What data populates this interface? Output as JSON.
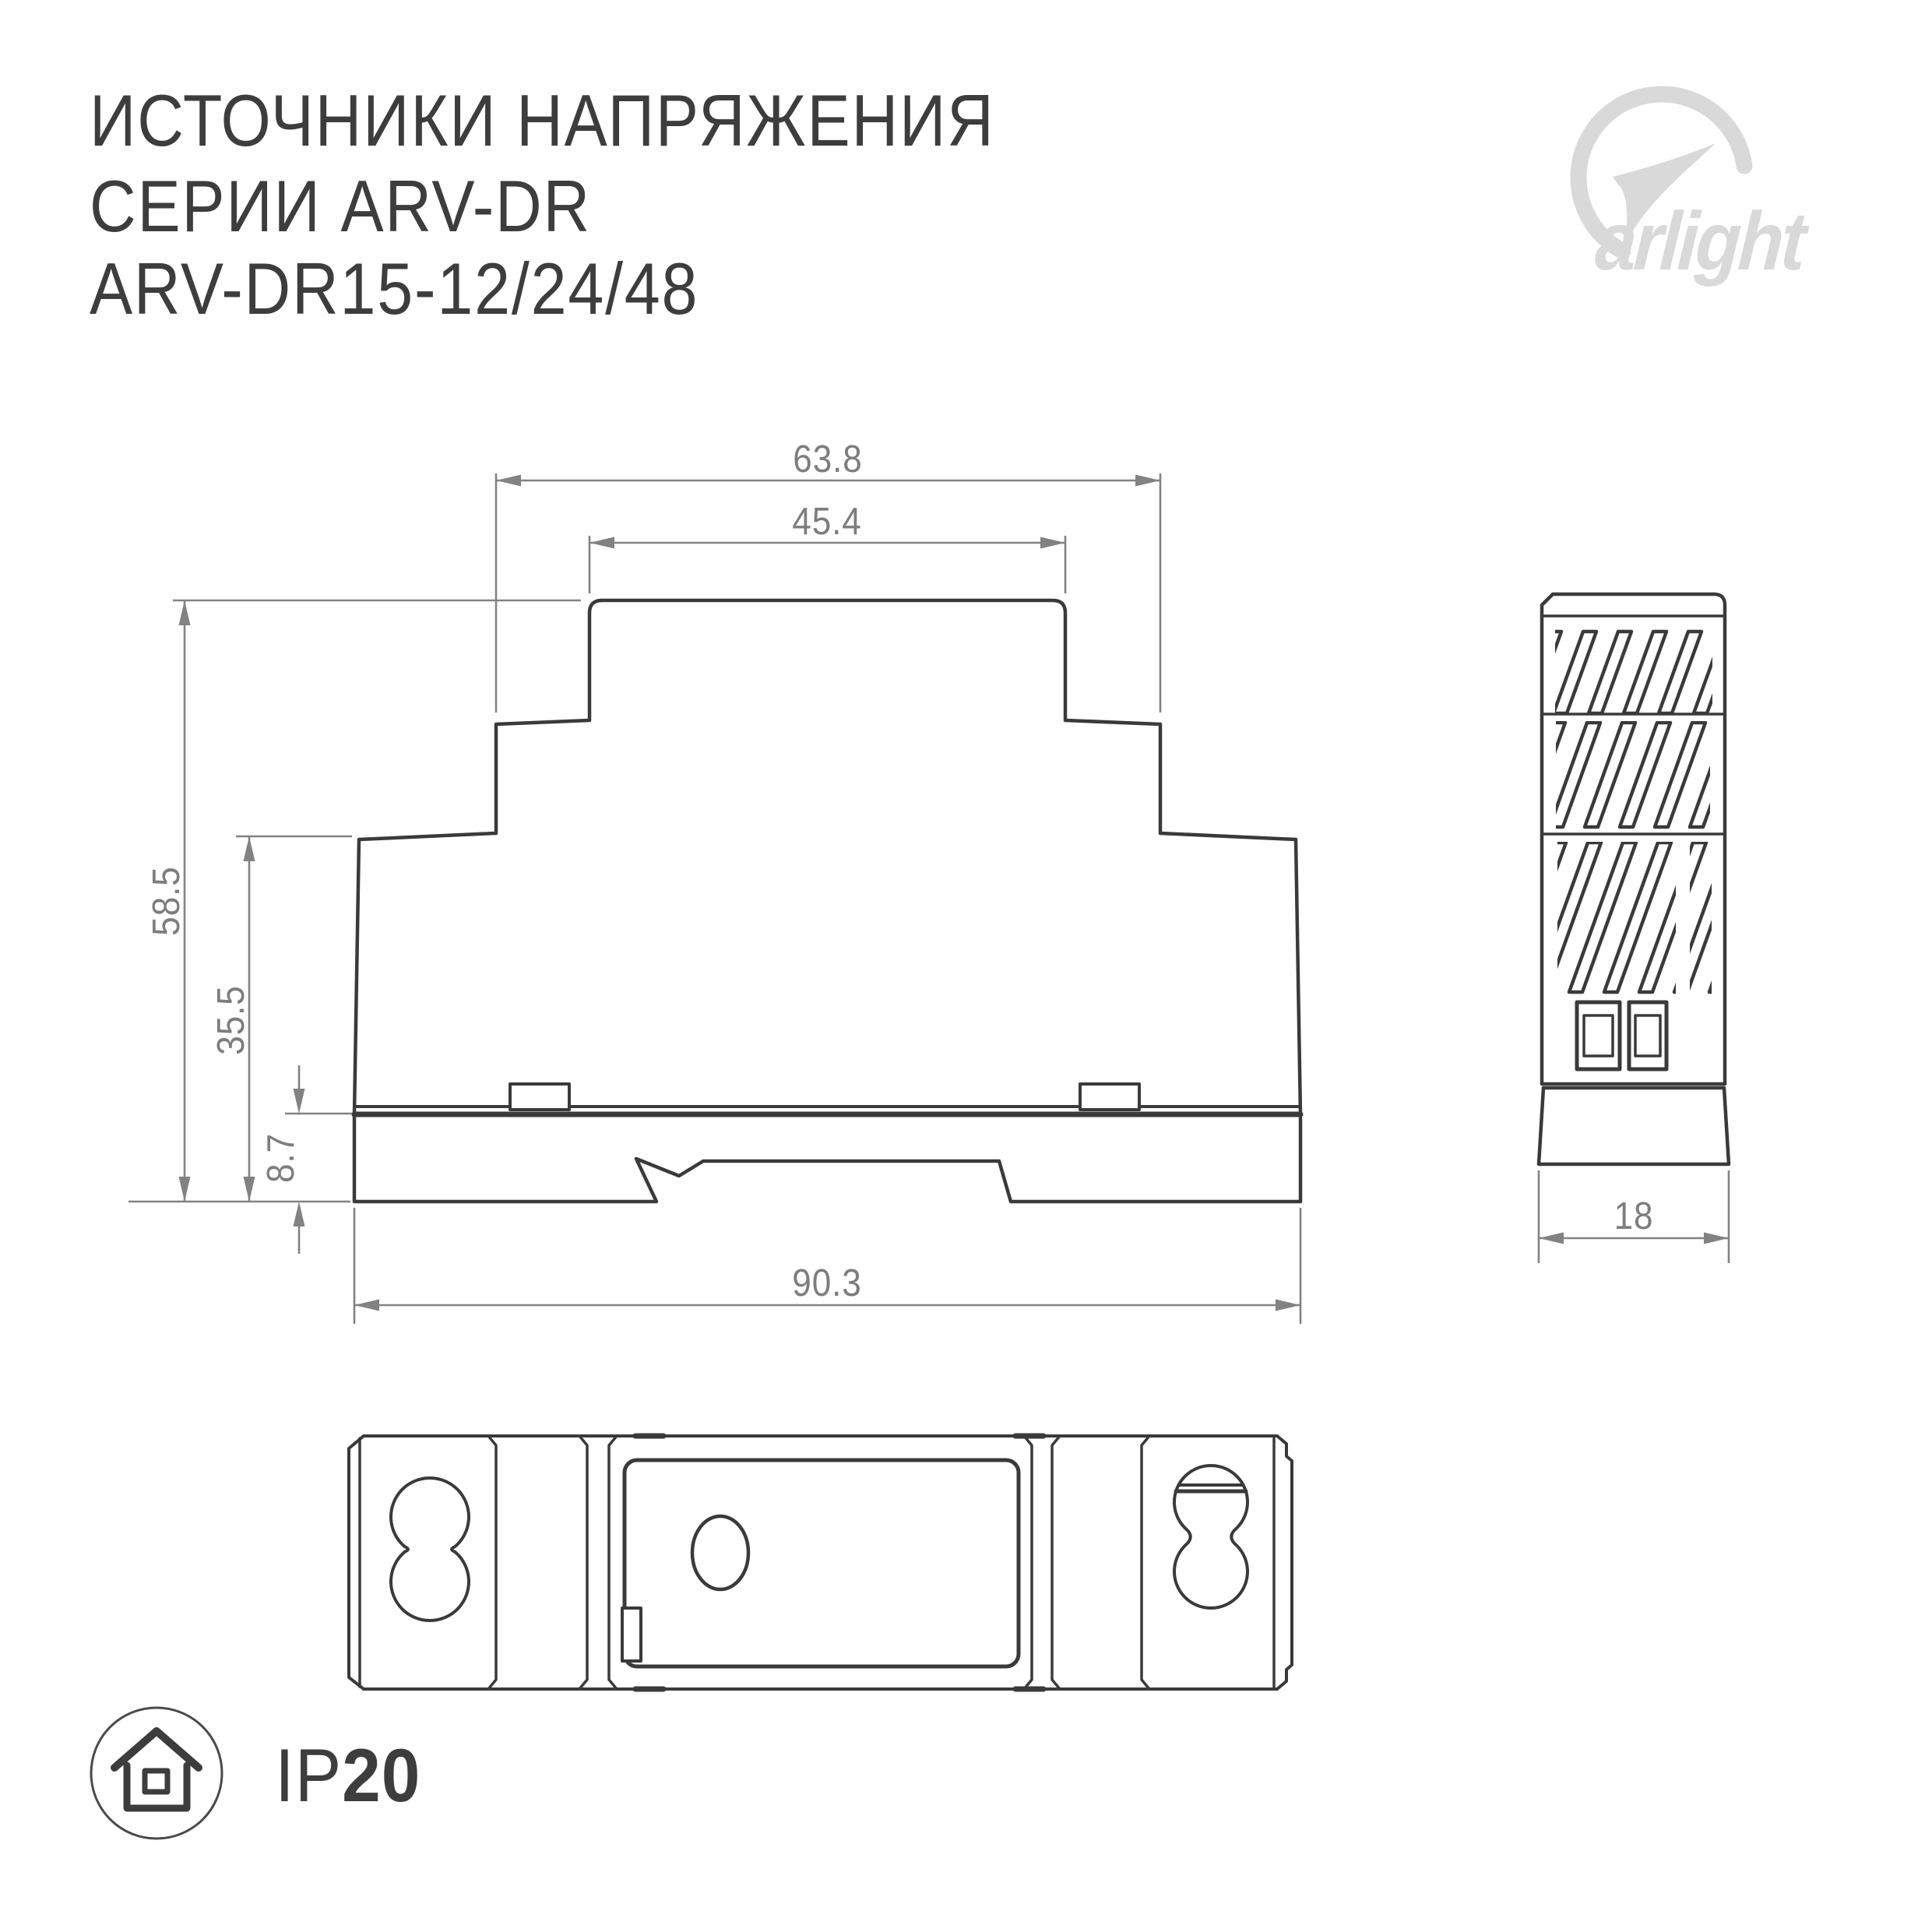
{
  "title": {
    "line1": "ИСТОЧНИКИ НАПРЯЖЕНИЯ",
    "line2": "СЕРИИ ARV-DR",
    "line3": "ARV-DR15-12/24/48"
  },
  "logo": {
    "brand": "arlight"
  },
  "dimensions": {
    "front_view": {
      "top_outer_width": "63.8",
      "top_inner_width": "45.4",
      "total_height": "58.5",
      "upper_height": "35.5",
      "base_height": "8.7",
      "base_width": "90.3"
    },
    "side_view": {
      "depth": "18"
    }
  },
  "ip_badge": {
    "prefix": "IP",
    "rating": "20",
    "icon": "house-in-circle-icon"
  },
  "colors": {
    "drawing_ink": "#3a3a3a",
    "dimension_gray": "#828282",
    "logo_gray": "#d9d9d9",
    "text_dark": "#3d3d3d",
    "background": "#ffffff"
  }
}
